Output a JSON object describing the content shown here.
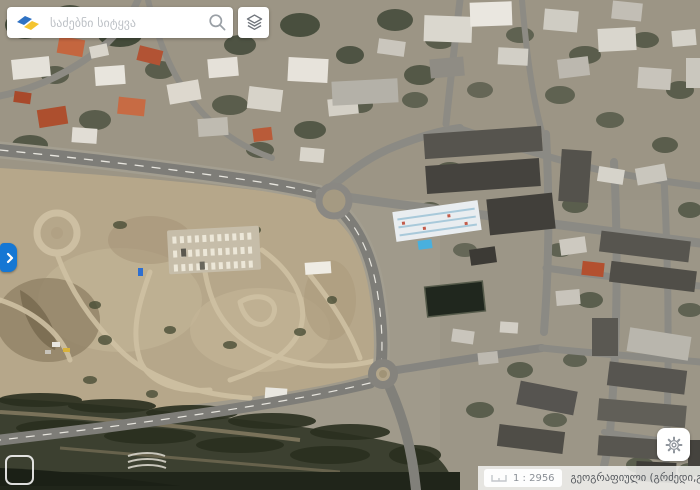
{
  "search": {
    "placeholder": "საძებნი სიტყვა",
    "value": ""
  },
  "statusbar": {
    "scale": "1 : 2956",
    "coordinate_system": "გეოგრაფიული (გრძედი,განედი)"
  },
  "colors": {
    "accent_blue": "#1577d4",
    "logo_blue": "#2f72c4",
    "logo_yellow": "#f4c430",
    "statusbar_text": "#54585d"
  }
}
